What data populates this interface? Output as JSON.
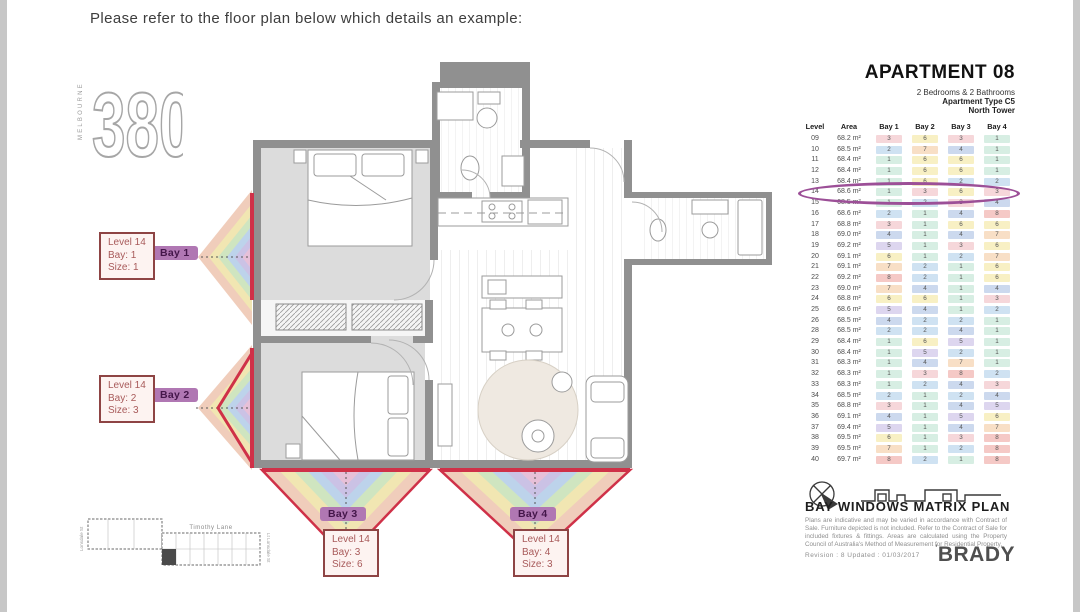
{
  "page": {
    "title": "Please refer to the floor plan below which details an example:"
  },
  "logo": {
    "number": "380",
    "city": "MELBOURNE"
  },
  "apartment": {
    "title": "APARTMENT 08",
    "line1": "2 Bedrooms & 2 Bathrooms",
    "line2": "Apartment Type C5",
    "line3": "North Tower"
  },
  "table": {
    "columns": [
      "Level",
      "Area",
      "Bay 1",
      "Bay 2",
      "Bay 3",
      "Bay 4"
    ],
    "highlight_level": "14",
    "highlight_color": "#9c4f97",
    "value_colors": {
      "1": "#d7eee3",
      "2": "#cfe2f2",
      "3": "#f6d7da",
      "4": "#ccd9ee",
      "5": "#ddd6ef",
      "6": "#f8f0c4",
      "7": "#f8dfc6",
      "8": "#f5c9c6"
    },
    "rows": [
      {
        "level": "09",
        "area": "68.2 m²",
        "bays": [
          3,
          6,
          3,
          1
        ]
      },
      {
        "level": "10",
        "area": "68.5 m²",
        "bays": [
          2,
          7,
          4,
          1
        ]
      },
      {
        "level": "11",
        "area": "68.4 m²",
        "bays": [
          1,
          6,
          6,
          1
        ]
      },
      {
        "level": "12",
        "area": "68.4 m²",
        "bays": [
          1,
          6,
          6,
          1
        ]
      },
      {
        "level": "13",
        "area": "68.4 m²",
        "bays": [
          1,
          6,
          2,
          2
        ]
      },
      {
        "level": "14",
        "area": "68.6 m²",
        "bays": [
          1,
          3,
          6,
          3
        ]
      },
      {
        "level": "15",
        "area": "68.5 m²",
        "bays": [
          1,
          2,
          3,
          4
        ]
      },
      {
        "level": "16",
        "area": "68.6 m²",
        "bays": [
          2,
          1,
          4,
          8
        ]
      },
      {
        "level": "17",
        "area": "68.8 m²",
        "bays": [
          3,
          1,
          6,
          6
        ]
      },
      {
        "level": "18",
        "area": "69.0 m²",
        "bays": [
          4,
          1,
          4,
          7
        ]
      },
      {
        "level": "19",
        "area": "69.2 m²",
        "bays": [
          5,
          1,
          3,
          6
        ]
      },
      {
        "level": "20",
        "area": "69.1 m²",
        "bays": [
          6,
          1,
          2,
          7
        ]
      },
      {
        "level": "21",
        "area": "69.1 m²",
        "bays": [
          7,
          2,
          1,
          6
        ]
      },
      {
        "level": "22",
        "area": "69.2 m²",
        "bays": [
          8,
          2,
          1,
          6
        ]
      },
      {
        "level": "23",
        "area": "69.0 m²",
        "bays": [
          7,
          4,
          1,
          4
        ]
      },
      {
        "level": "24",
        "area": "68.8 m²",
        "bays": [
          6,
          6,
          1,
          3
        ]
      },
      {
        "level": "25",
        "area": "68.6 m²",
        "bays": [
          5,
          4,
          1,
          2
        ]
      },
      {
        "level": "26",
        "area": "68.5 m²",
        "bays": [
          4,
          2,
          2,
          1
        ]
      },
      {
        "level": "28",
        "area": "68.5 m²",
        "bays": [
          2,
          2,
          4,
          1
        ]
      },
      {
        "level": "29",
        "area": "68.4 m²",
        "bays": [
          1,
          6,
          5,
          1
        ]
      },
      {
        "level": "30",
        "area": "68.4 m²",
        "bays": [
          1,
          5,
          2,
          1
        ]
      },
      {
        "level": "31",
        "area": "68.3 m²",
        "bays": [
          1,
          4,
          7,
          1
        ]
      },
      {
        "level": "32",
        "area": "68.3 m²",
        "bays": [
          1,
          3,
          8,
          2
        ]
      },
      {
        "level": "33",
        "area": "68.3 m²",
        "bays": [
          1,
          2,
          4,
          3
        ]
      },
      {
        "level": "34",
        "area": "68.5 m²",
        "bays": [
          2,
          1,
          2,
          4
        ]
      },
      {
        "level": "35",
        "area": "68.8 m²",
        "bays": [
          3,
          1,
          4,
          5
        ]
      },
      {
        "level": "36",
        "area": "69.1 m²",
        "bays": [
          4,
          1,
          5,
          6
        ]
      },
      {
        "level": "37",
        "area": "69.4 m²",
        "bays": [
          5,
          1,
          4,
          7
        ]
      },
      {
        "level": "38",
        "area": "69.5 m²",
        "bays": [
          6,
          1,
          3,
          8
        ]
      },
      {
        "level": "39",
        "area": "69.5 m²",
        "bays": [
          7,
          1,
          2,
          8
        ]
      },
      {
        "level": "40",
        "area": "69.7 m²",
        "bays": [
          8,
          2,
          1,
          8
        ]
      }
    ]
  },
  "bays": [
    {
      "pill": "Bay 1",
      "level": "Level 14",
      "bay": "Bay: 1",
      "size": "Size: 1"
    },
    {
      "pill": "Bay 2",
      "level": "Level 14",
      "bay": "Bay: 2",
      "size": "Size: 3"
    },
    {
      "pill": "Bay 3",
      "level": "Level 14",
      "bay": "Bay: 3",
      "size": "Size: 6"
    },
    {
      "pill": "Bay 4",
      "level": "Level 14",
      "bay": "Bay: 4",
      "size": "Size: 3"
    }
  ],
  "plan": {
    "red": "#cf3148",
    "fan_colors": [
      "#f0cdbb",
      "#f1e6b2",
      "#cfe5c0",
      "#bdd3eb",
      "#cbc2e5",
      "#e7c0d8"
    ]
  },
  "site_plan": {
    "street": "Timothy Lane",
    "left_label": "Lonsdale St",
    "right_label": "Lt Lonsdale St"
  },
  "footer": {
    "plan_title": "BAY WINDOWS MATRIX PLAN",
    "disclaimer": "Plans are indicative and may be varied in accordance with Contract of Sale. Furniture depicted is not included. Refer to the Contract of Sale for included fixtures & fittings. Areas are calculated using the Property Council of Australia's Method of Measurement for Residential Property.",
    "revision": "Revision :   8    Updated :   01/03/2017",
    "brand": "BRADY",
    "brand_mark": "'"
  }
}
